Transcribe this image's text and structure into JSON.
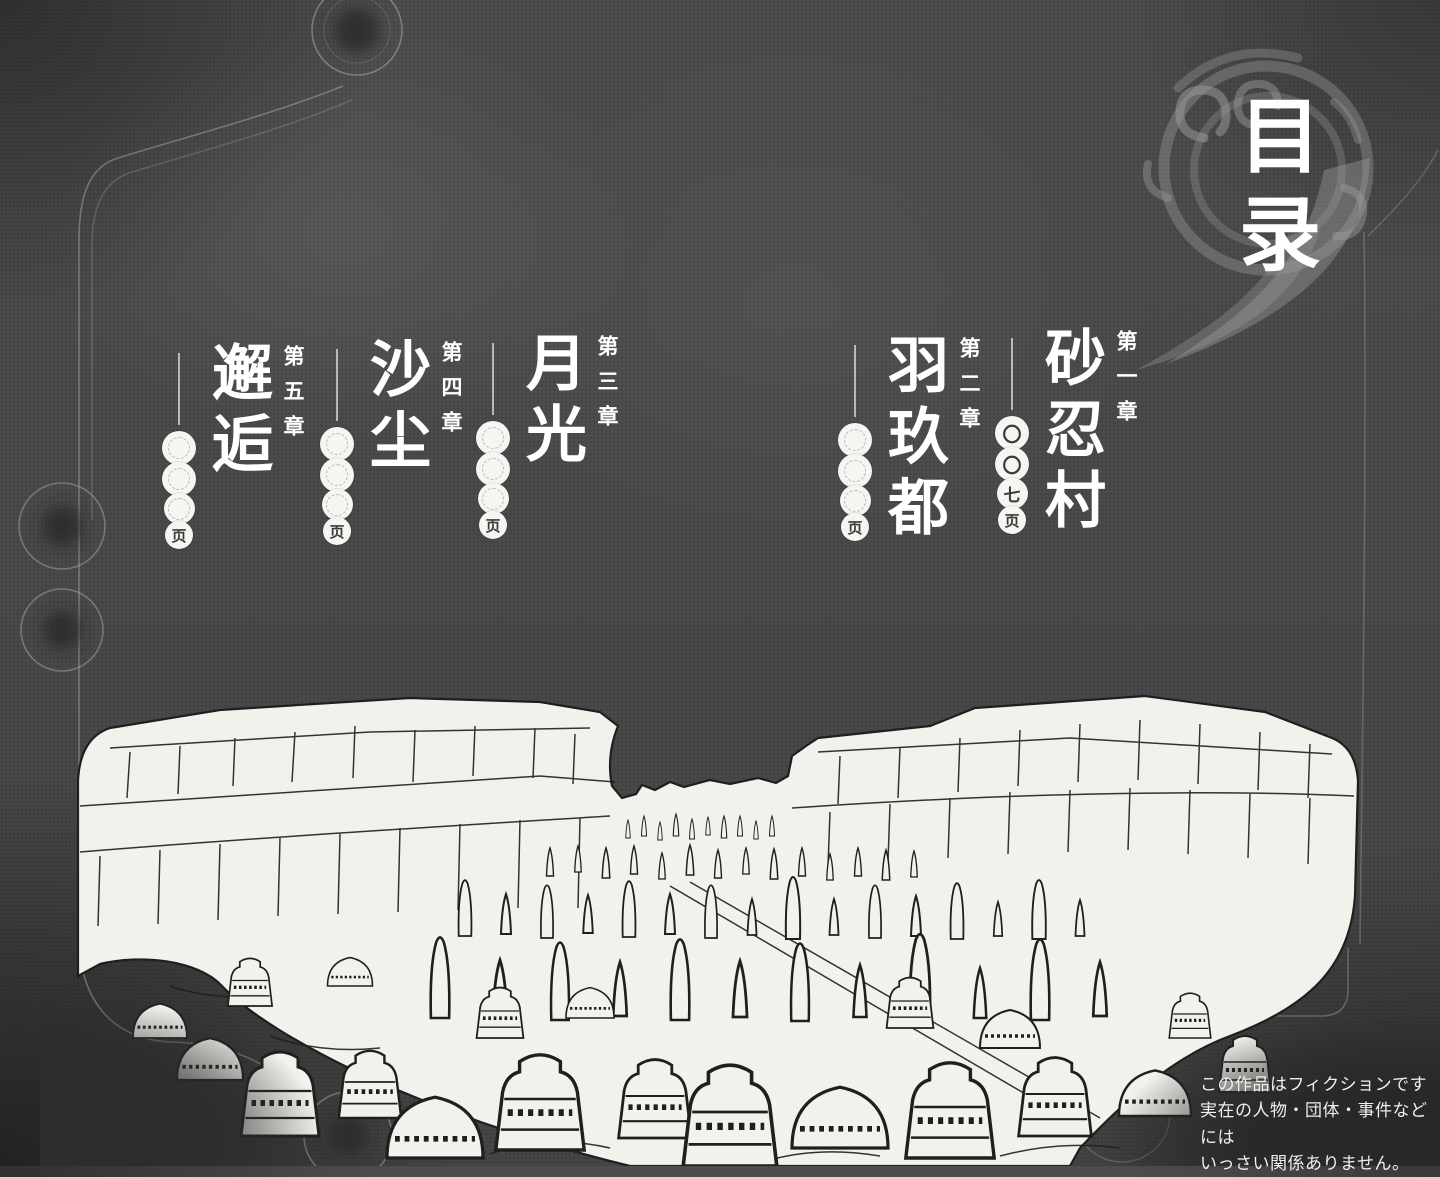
{
  "emblem": {
    "chars": [
      "目",
      "录"
    ]
  },
  "toc": {
    "chapters": [
      {
        "label": "第一章",
        "title": "砂忍村",
        "pages": [
          "〇",
          "〇",
          "七",
          "页"
        ]
      },
      {
        "label": "第二章",
        "title": "羽玖都",
        "pages": [
          "",
          "",
          "",
          "页"
        ]
      },
      {
        "label": "第三章",
        "title": "月光",
        "pages": [
          "",
          "",
          "",
          "页"
        ]
      },
      {
        "label": "第四章",
        "title": "沙尘",
        "pages": [
          "",
          "",
          "",
          "页"
        ]
      },
      {
        "label": "第五章",
        "title": "邂逅",
        "pages": [
          "",
          "",
          "",
          "页"
        ]
      }
    ]
  },
  "disclaimer": {
    "line1": "この作品はフィクションです",
    "line2": "実在の人物・団体・事件などには",
    "line3": "いっさい関係ありません。"
  },
  "colors": {
    "background": "#4a4a4a",
    "ink": "#1f1f1f",
    "paper": "#f2f1ec",
    "frame_line": "#a8a8a8",
    "text": "#ffffff"
  }
}
